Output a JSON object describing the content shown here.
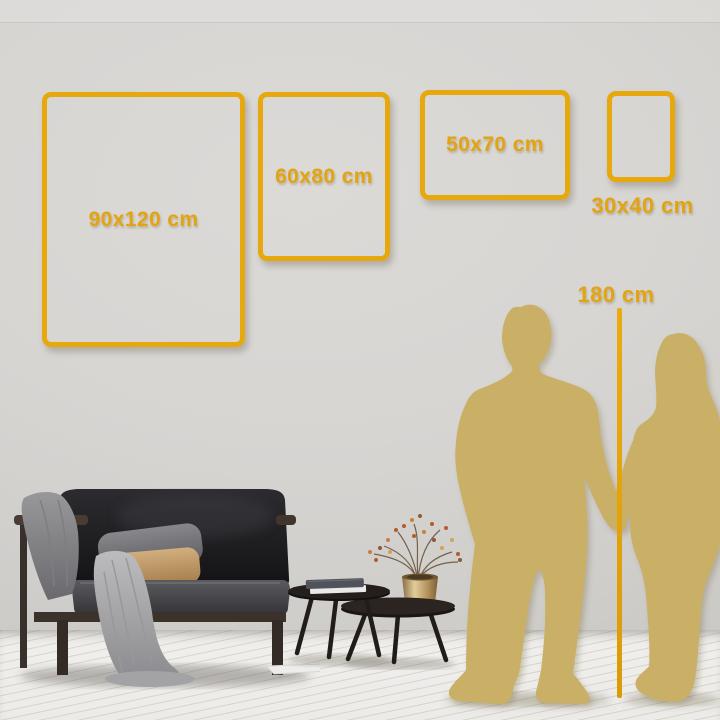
{
  "colors": {
    "accent_gold": "#E7A80D",
    "label_gold": "#E2A411",
    "silhouette_gold": "#C9B066",
    "wall": "#D6D4D1",
    "floor": "#EDECE9"
  },
  "size_guide": {
    "frames": [
      {
        "label": "90x120 cm"
      },
      {
        "label": "60x80 cm"
      },
      {
        "label": "50x70 cm"
      },
      {
        "label": "30x40 cm"
      }
    ],
    "height_reference": {
      "label": "180 cm"
    }
  }
}
